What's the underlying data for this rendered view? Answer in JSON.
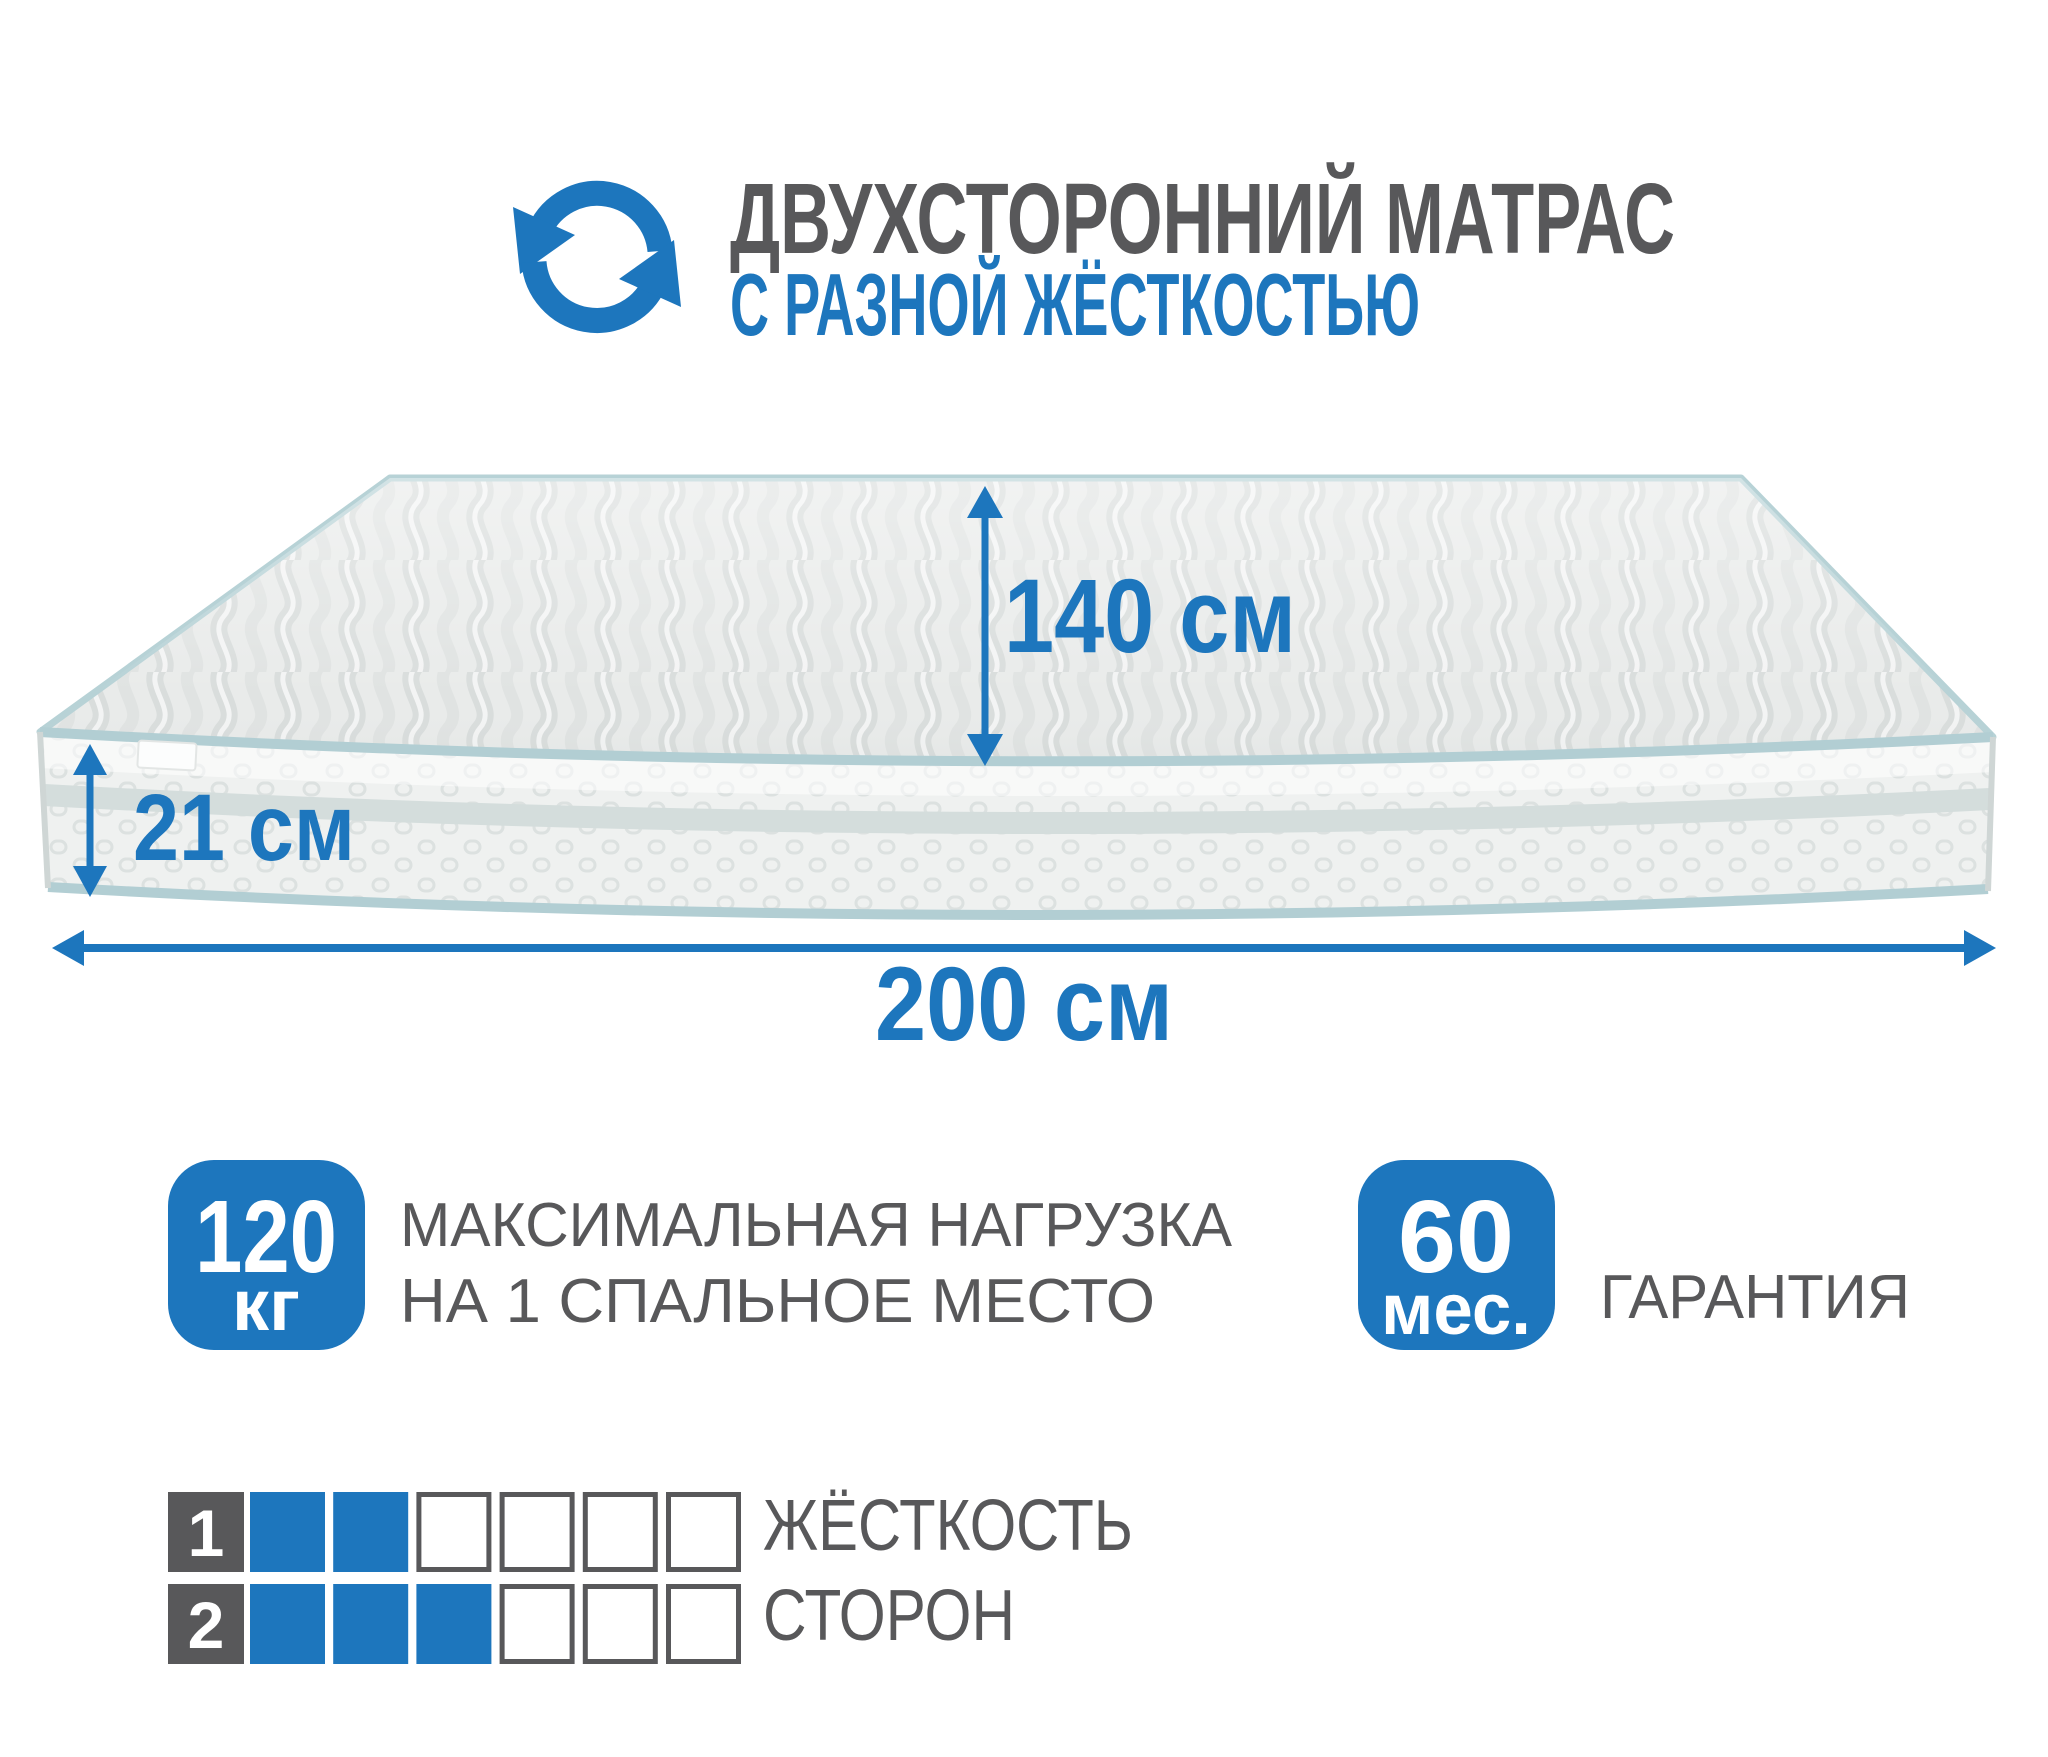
{
  "colors": {
    "accent_blue": "#1d76bd",
    "text_gray": "#58585a",
    "piping_teal": "#b2ced3",
    "band_gray": "#d4dddc",
    "mattress_top": "#e9ebea",
    "mattress_side": "#eff1f0",
    "background": "#ffffff"
  },
  "header": {
    "icon": "rotate-arrows-icon",
    "title": "ДВУХСТОРОННИЙ МАТРАС",
    "subtitle": "С РАЗНОЙ ЖЁСТКОСТЬЮ"
  },
  "mattress": {
    "depth_label": "140 см",
    "height_label": "21 см",
    "width_label": "200 см"
  },
  "badges": {
    "max_load": {
      "value": "120",
      "unit": "кг",
      "line1": "МАКСИМАЛЬНАЯ НАГРУЗКА",
      "line2": "НА 1 СПАЛЬНОЕ МЕСТО"
    },
    "warranty": {
      "value": "60",
      "unit": "мес.",
      "label": "ГАРАНТИЯ"
    }
  },
  "firmness": {
    "caption_line1": "ЖЁСТКОСТЬ",
    "caption_line2": "СТОРОН",
    "scale_max": 6,
    "rows": [
      {
        "label": "1",
        "filled": 2
      },
      {
        "label": "2",
        "filled": 3
      }
    ]
  }
}
